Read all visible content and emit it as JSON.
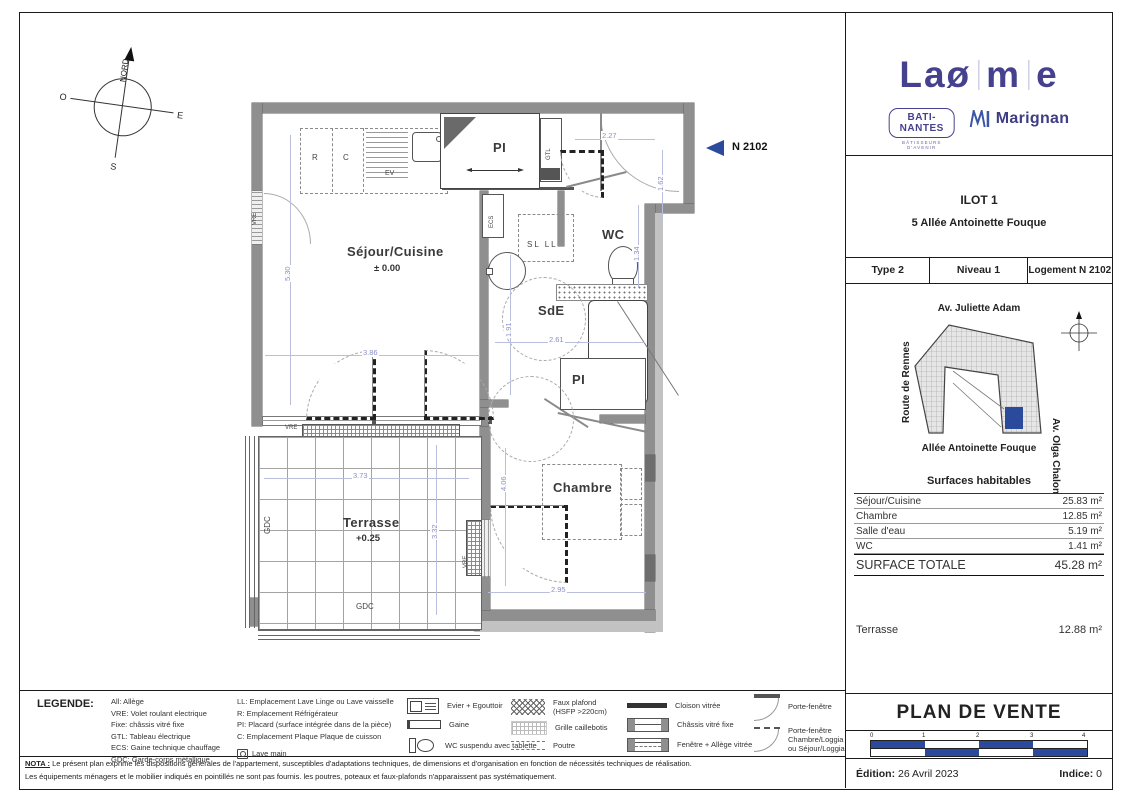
{
  "compass": {
    "north": "NORD",
    "south": "S",
    "east": "E",
    "west": "O"
  },
  "marker": {
    "label": "N 2102"
  },
  "plan": {
    "rooms": {
      "sejour": "Séjour/Cuisine",
      "sejour_level": "± 0.00",
      "wc": "WC",
      "sde": "SdE",
      "chambre": "Chambre",
      "terrasse": "Terrasse",
      "terrasse_level": "+0.25",
      "pi_top": "PI",
      "pi_mid": "PI"
    },
    "annotations": {
      "r": "R",
      "c": "C",
      "ev": "EV",
      "sl_ll": "SL  LL",
      "ecs": "ECS",
      "gtl": "GTL",
      "vre_left": "VRE",
      "vre_top": "VRE",
      "vre_right": "VRE",
      "gdc_left": "GDC",
      "gdc_bottom": "GDC"
    },
    "dims": {
      "entry_w": "2.27",
      "entry_h": "1.62",
      "sejour_h": "5.30",
      "sejour_w": "3.86",
      "sde_w": "2.61",
      "sde_h": "1.91",
      "wc_h": "1.34",
      "terrasse_w": "3.73",
      "terrasse_h": "3.32",
      "chambre_h": "4.06",
      "chambre_w": "2.95"
    }
  },
  "titleblock": {
    "logo": {
      "l1": "L",
      "l2": "a",
      "l3": "ø",
      "l4": "m",
      "l5": "e",
      "partner1": "BATI-NANTES",
      "partner1_sub": "BÂTISSEURS D'AVENIR",
      "partner2": "Marignan"
    },
    "ilot": "ILOT 1",
    "address": "5 Allée Antoinette Fouque",
    "type_row": {
      "c1": "Type 2",
      "c2": "Niveau 1",
      "c3": "Logement N 2102"
    },
    "map": {
      "street_top": "Av. Juliette Adam",
      "street_left": "Route de Rennes",
      "street_right": "Av. Olga Chalon",
      "street_bottom": "Allée Antoinette Fouque"
    },
    "surfaces": {
      "title": "Surfaces habitables",
      "rows": [
        {
          "label": "Séjour/Cuisine",
          "value": "25.83 m²"
        },
        {
          "label": "Chambre",
          "value": "12.85 m²"
        },
        {
          "label": "Salle d'eau",
          "value": "5.19 m²"
        },
        {
          "label": "WC",
          "value": "1.41 m²"
        }
      ],
      "total_label": "SURFACE TOTALE",
      "total_value": "45.28 m²",
      "terrasse_label": "Terrasse",
      "terrasse_value": "12.88 m²"
    },
    "doc_title": "PLAN DE VENTE",
    "scale_ticks": {
      "t0": "0",
      "t1": "1",
      "t2": "2",
      "t3": "3",
      "t4": "4"
    },
    "edition_label": "Édition:",
    "edition_value": "26 Avril 2023",
    "indice_label": "Indice:",
    "indice_value": "0"
  },
  "legend": {
    "title": "LEGENDE:",
    "col1": [
      "All: Allège",
      "VRE: Volet roulant electrique",
      "Fixe: châssis vitré fixe",
      "GTL: Tableau électrique",
      "ECS: Gaine technique chauffage",
      "GDC: Garde-corps métallique"
    ],
    "col2": [
      "LL: Emplacement Lave Linge ou Lave vaisselle",
      "R: Emplacement Réfrigérateur",
      "PI: Placard (surface intégrée dans de la pièce)",
      "C: Emplacement Plaque Plaque de cuisson"
    ],
    "lave_main": "Lave main",
    "icons1": [
      "Evier + Egouttoir",
      "Gaine",
      "WC suspendu avec tablette"
    ],
    "icons2_l1a": "Faux plafond",
    "icons2_l1b": "(HSFP >220cm)",
    "icons2_l2": "Grille caillebotis",
    "icons2_l3": "Poutre",
    "icons3": [
      "Cloison vitrée",
      "Châssis vitré fixe",
      "Fenêtre + Allège vitrée"
    ],
    "icons4_l1": "Porte-fenêtre",
    "icons4_l2a": "Porte-fenêtre",
    "icons4_l2b": "Chambre/Loggia",
    "icons4_l2c": "ou Séjour/Loggia"
  },
  "nota": {
    "label": "NOTA :",
    "line1": "Le présent plan exprime les dispositions générales de l'appartement, susceptibles d'adaptations techniques, de dimensions et d'organisation en fonction de nécessités techniques de réalisation.",
    "line2": "Les équipements ménagers et le mobilier indiqués en pointillés ne sont pas fournis. les poutres, poteaux et faux-plafonds n'apparaissent pas systématiquement."
  }
}
